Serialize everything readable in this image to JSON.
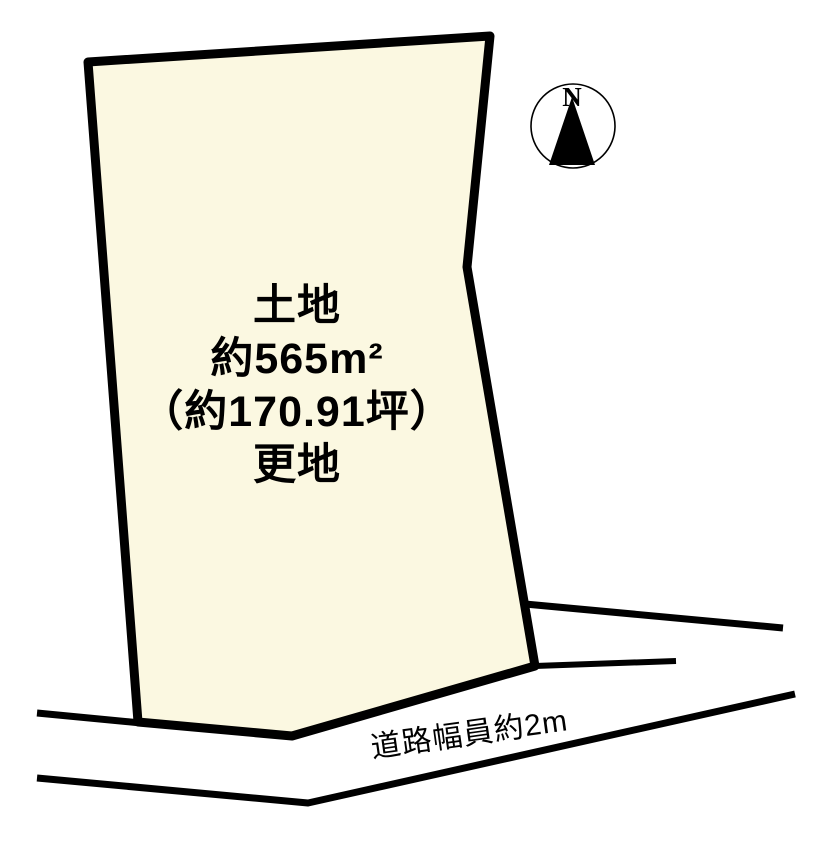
{
  "diagram": {
    "parcel": {
      "fill_color": "#fbf8e1",
      "outline_color": "#000000",
      "label_lines": [
        "土地",
        "約565m²",
        "（約170.91坪）",
        "更地"
      ]
    },
    "road": {
      "width_label": "道路幅員約2m"
    },
    "compass": {
      "north_label": "N"
    }
  }
}
